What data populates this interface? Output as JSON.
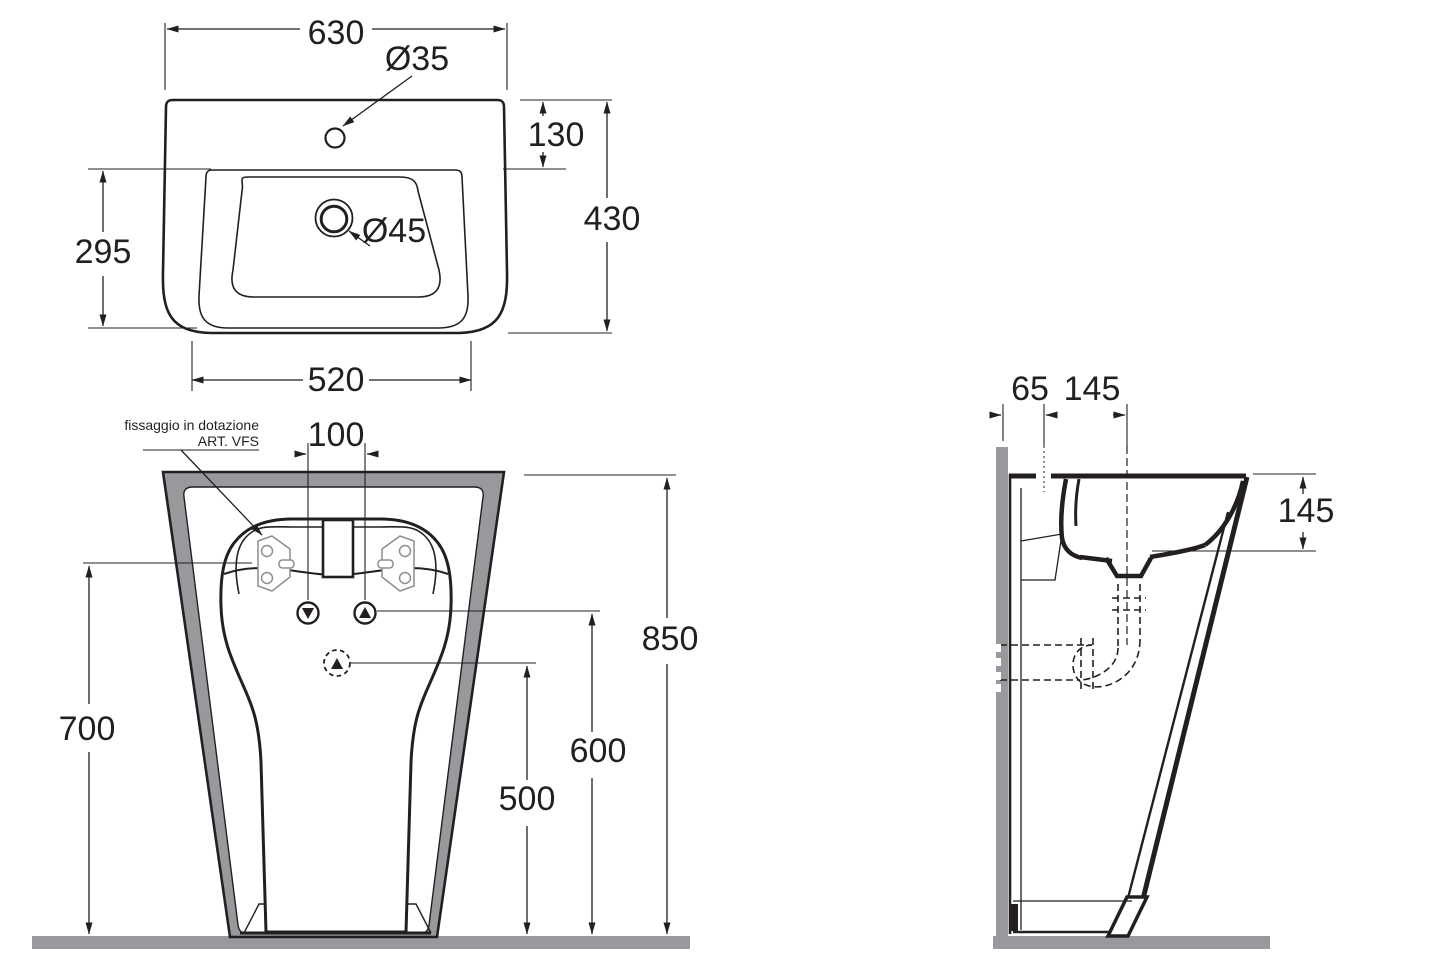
{
  "drawing": {
    "product": "pedestal-washbasin-technical-drawing",
    "top_view": {
      "width": "630",
      "faucet_hole": "Ø35",
      "deck_depth": "130",
      "overall_depth": "430",
      "basin_depth": "295",
      "front_width": "520"
    },
    "front_view": {
      "fixing_note_line1": "fissaggio in dotazione",
      "fixing_note_line2": "ART. VFS",
      "tap_spacing": "100",
      "fixing_height": "700",
      "overall_height": "850",
      "supply_height": "600",
      "drain_height": "500"
    },
    "side_view": {
      "wall_offset": "65",
      "drain_wall_distance": "145",
      "bowl_depth": "145"
    }
  },
  "colors": {
    "line": "#231f20",
    "gray": "#97999c",
    "plate_outline": "#8c8e91"
  }
}
